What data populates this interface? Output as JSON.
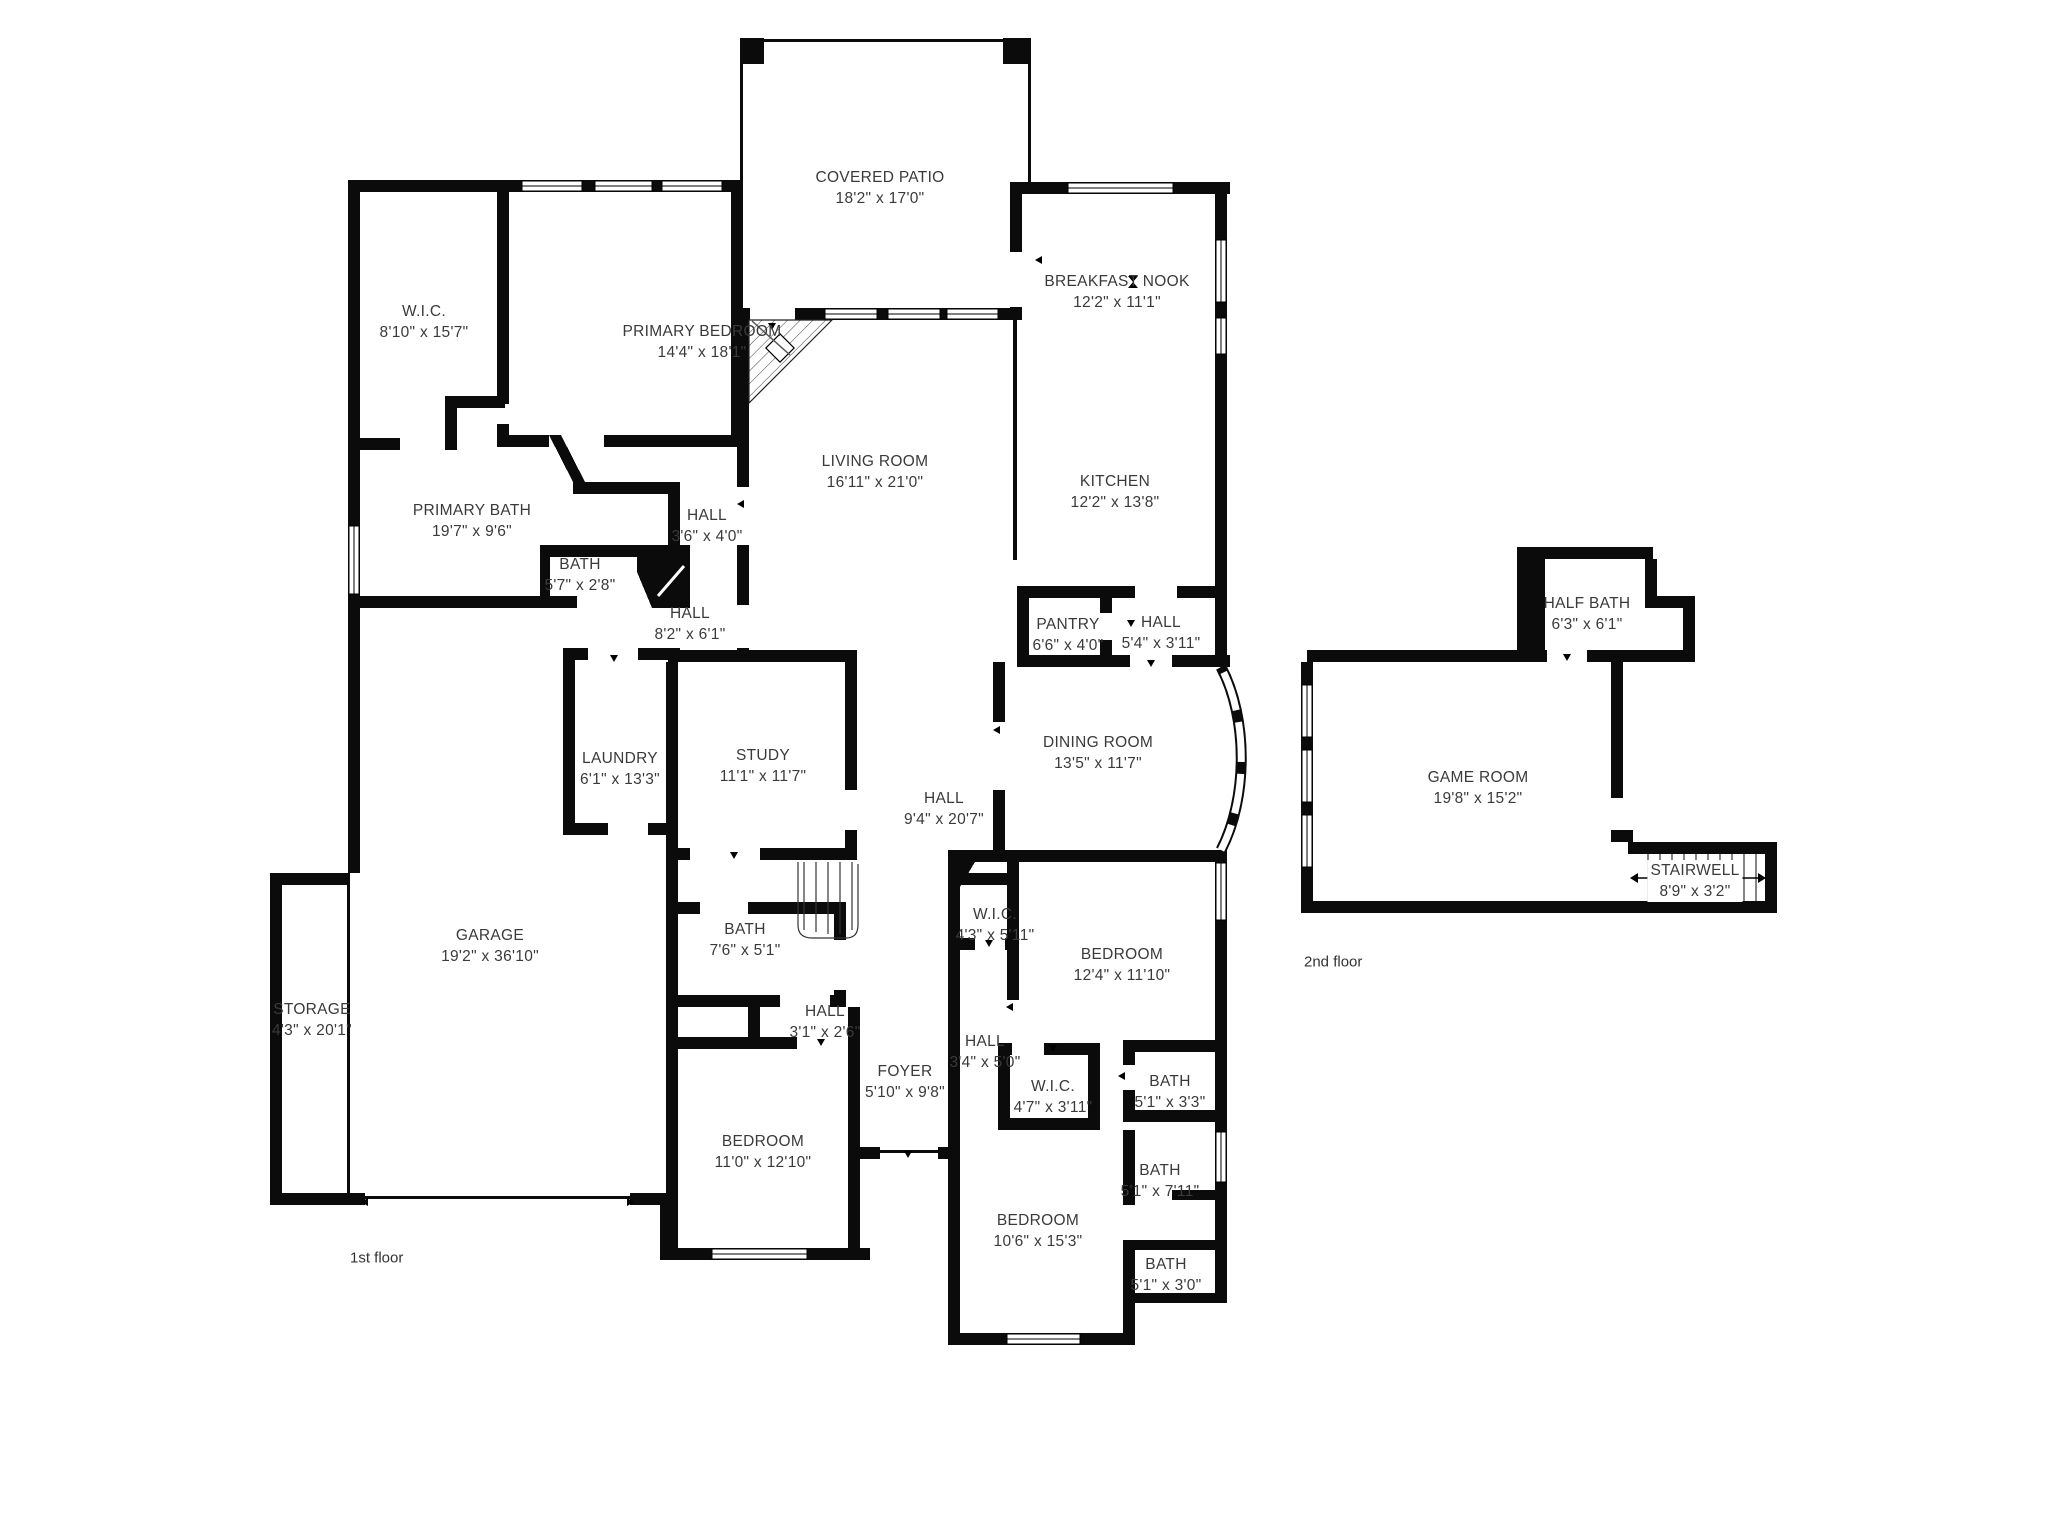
{
  "drawing": {
    "background": "#ffffff",
    "wall_color": "#0b0b0b",
    "label_color": "#3a3a3a"
  },
  "floors": [
    {
      "caption": "1st floor"
    },
    {
      "caption": "2nd floor"
    }
  ],
  "rooms": {
    "covered_patio": {
      "name": "COVERED PATIO",
      "dims": "18'2\" x 17'0\""
    },
    "breakfast_nook": {
      "name": "BREAKFAST NOOK",
      "dims": "12'2\" x 11'1\""
    },
    "wic_primary": {
      "name": "W.I.C.",
      "dims": "8'10\" x 15'7\""
    },
    "primary_bedroom": {
      "name": "PRIMARY BEDROOM",
      "dims": "14'4\" x 18'1\""
    },
    "living_room": {
      "name": "LIVING ROOM",
      "dims": "16'11\" x 21'0\""
    },
    "kitchen": {
      "name": "KITCHEN",
      "dims": "12'2\" x 13'8\""
    },
    "primary_bath": {
      "name": "PRIMARY BATH",
      "dims": "19'7\" x 9'6\""
    },
    "hall_a": {
      "name": "HALL",
      "dims": "3'6\" x 4'0\""
    },
    "bath_a": {
      "name": "BATH",
      "dims": "5'7\" x 2'8\""
    },
    "hall_b": {
      "name": "HALL",
      "dims": "8'2\" x 6'1\""
    },
    "pantry": {
      "name": "PANTRY",
      "dims": "6'6\" x 4'0\""
    },
    "hall_c": {
      "name": "HALL",
      "dims": "5'4\" x 3'11\""
    },
    "dining_room": {
      "name": "DINING ROOM",
      "dims": "13'5\" x 11'7\""
    },
    "laundry": {
      "name": "LAUNDRY",
      "dims": "6'1\" x 13'3\""
    },
    "study": {
      "name": "STUDY",
      "dims": "11'1\" x 11'7\""
    },
    "hall_d": {
      "name": "HALL",
      "dims": "9'4\" x 20'7\""
    },
    "bath_b": {
      "name": "BATH",
      "dims": "7'6\" x 5'1\""
    },
    "garage": {
      "name": "GARAGE",
      "dims": "19'2\" x 36'10\""
    },
    "wic_b": {
      "name": "W.I.C.",
      "dims": "4'3\" x 5'11\""
    },
    "bedroom_a": {
      "name": "BEDROOM",
      "dims": "12'4\" x 11'10\""
    },
    "storage": {
      "name": "STORAGE",
      "dims": "4'3\" x 20'1\""
    },
    "hall_e": {
      "name": "HALL",
      "dims": "3'1\" x 2'6\""
    },
    "hall_f": {
      "name": "HALL",
      "dims": "3'4\" x 5'0\""
    },
    "foyer": {
      "name": "FOYER",
      "dims": "5'10\" x 9'8\""
    },
    "wic_c": {
      "name": "W.I.C.",
      "dims": "4'7\" x 3'11\""
    },
    "bath_c": {
      "name": "BATH",
      "dims": "5'1\" x 3'3\""
    },
    "bedroom_b": {
      "name": "BEDROOM",
      "dims": "11'0\" x 12'10\""
    },
    "bath_d": {
      "name": "BATH",
      "dims": "5'1\" x 7'11\""
    },
    "bedroom_c": {
      "name": "BEDROOM",
      "dims": "10'6\" x 15'3\""
    },
    "bath_e": {
      "name": "BATH",
      "dims": "5'1\" x 3'0\""
    },
    "half_bath": {
      "name": "HALF BATH",
      "dims": "6'3\" x 6'1\""
    },
    "game_room": {
      "name": "GAME ROOM",
      "dims": "19'8\" x 15'2\""
    },
    "stairwell": {
      "name": "STAIRWELL",
      "dims": "8'9\" x 3'2\""
    }
  }
}
